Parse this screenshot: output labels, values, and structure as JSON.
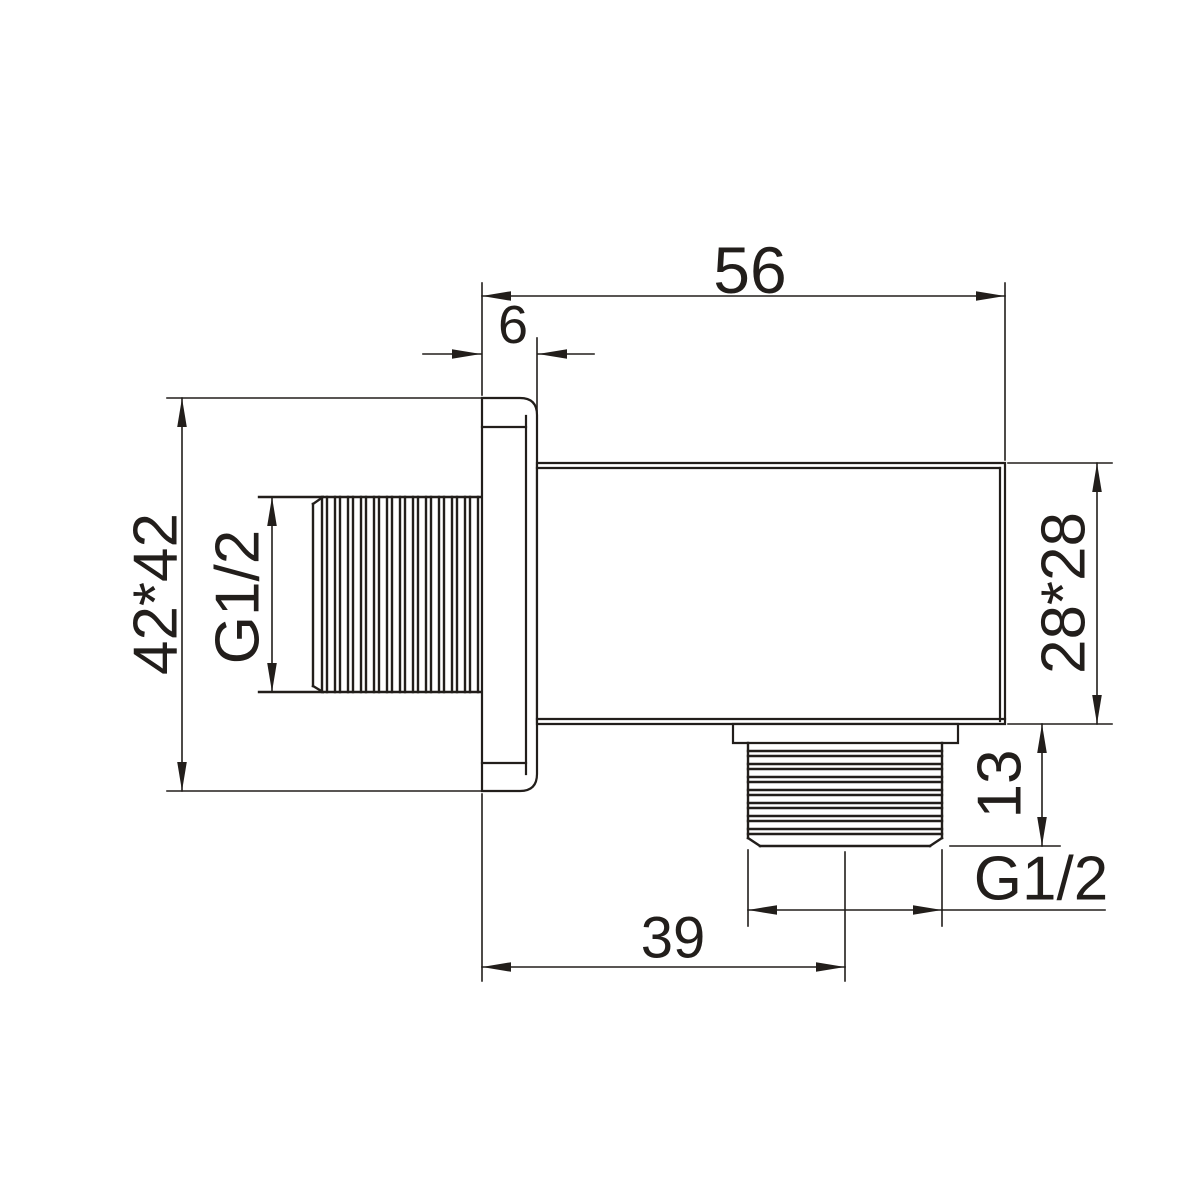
{
  "drawing": {
    "background_color": "#ffffff",
    "line_color": "#221e1b",
    "view": "side-section view of wall-mount shower outlet elbow",
    "dims": {
      "overall_length": "56",
      "flange_thickness": "6",
      "flange_size": "42*42",
      "wall_thread_spec": "G1/2",
      "body_size": "28*28",
      "outlet_thread_length": "13",
      "outlet_thread_spec": "G1/2",
      "outlet_center_offset": "39"
    }
  }
}
